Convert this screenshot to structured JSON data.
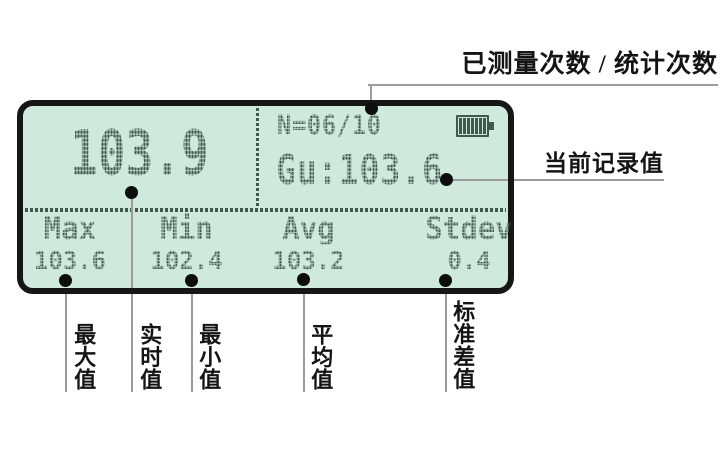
{
  "screen": {
    "main_reading": "103.9",
    "counter": "N=06/10",
    "current_record": "Gu:103.6",
    "stats": [
      {
        "label": "Max",
        "value": "103.6"
      },
      {
        "label": "Min",
        "value": "102.4"
      },
      {
        "label": "Avg",
        "value": "103.2"
      },
      {
        "label": "Stdev",
        "value": "0.4"
      }
    ]
  },
  "icons": {
    "battery": "battery-full-icon"
  },
  "annotations": {
    "measure_count": "已测量次数 / 统计次数",
    "current_record": "当前记录值",
    "max": "最大值",
    "realtime": "实时值",
    "min": "最小值",
    "avg": "平均值",
    "stdev": "标准差值"
  },
  "colors": {
    "screen_bg": "#cfeadd",
    "lcd_ink": "#40584f",
    "frame": "#161616",
    "callout_line": "#9c9c9c",
    "label_ink": "#141414"
  }
}
